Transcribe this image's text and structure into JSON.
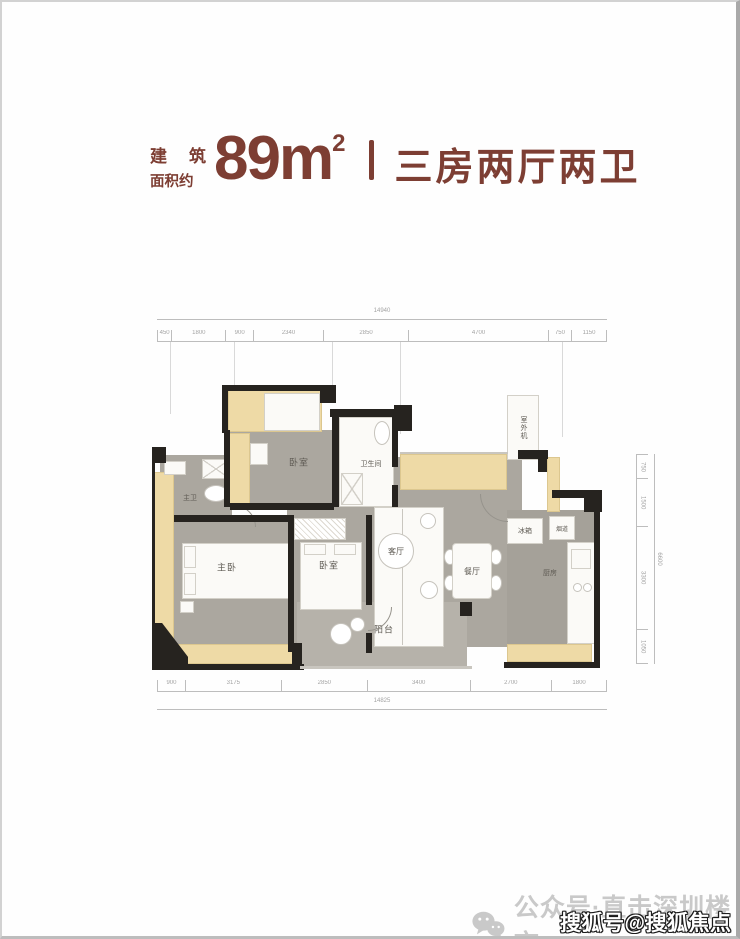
{
  "title": {
    "prefix_char1": "建",
    "prefix_char2": "筑",
    "prefix_line2": "面积约",
    "area_value": "89m",
    "area_sup": "2",
    "layout_text": "三房两厅两卫",
    "accent_color": "#7d3e33"
  },
  "floorplan": {
    "labels": {
      "master_bath": "主卫",
      "master_bedroom": "主卧",
      "bedroom2": "卧室",
      "bedroom3": "卧室",
      "bathroom": "卫生间",
      "living": "客厅",
      "dining": "餐厅",
      "kitchen": "厨房",
      "fridge": "冰箱",
      "flue": "烟道",
      "balcony": "阳台",
      "ac_unit": "室外机"
    },
    "dims": {
      "top_total": "14940",
      "top_segments": [
        "450",
        "1800",
        "900",
        "2340",
        "2850",
        "4700",
        "750",
        "1150"
      ],
      "bottom_segments": [
        "900",
        "3175",
        "2850",
        "3400",
        "2700",
        "1800"
      ],
      "bottom_total": "14825",
      "right_segments": [
        "750",
        "1500",
        "3300",
        "1050"
      ],
      "right_total": "6600"
    },
    "colors": {
      "wall": "#26231f",
      "window_bay": "#eedaa6",
      "floor_gray": "#aba79f",
      "balcony_floor": "#b6b2aa",
      "room_white": "#fbfaf7"
    }
  },
  "watermarks": {
    "wechat_text": "公众号·直击深圳楼市",
    "sohu_text": "搜狐号@搜狐焦点鞍山站"
  }
}
